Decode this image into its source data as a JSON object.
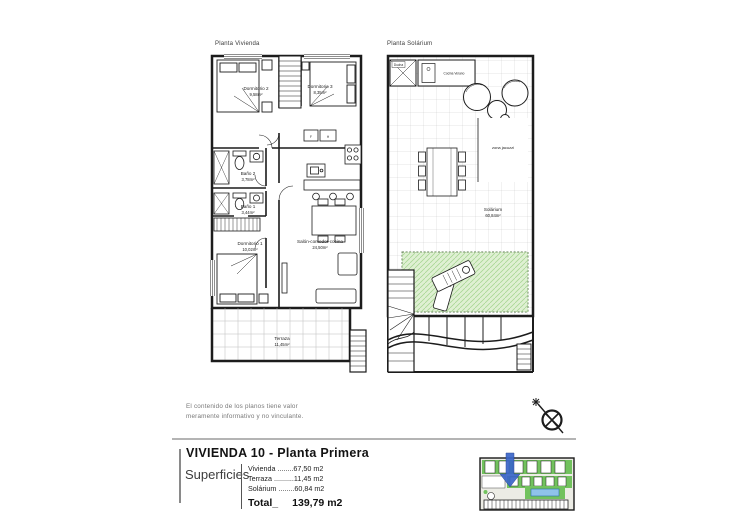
{
  "header": {
    "plan_left_title": "Planta Vivienda",
    "plan_right_title": "Planta Solárium"
  },
  "plan_left": {
    "rooms": [
      {
        "name": "Dormitorio 2",
        "area": "9,58m²"
      },
      {
        "name": "Dormitorio 3",
        "area": "8,35m²"
      },
      {
        "name": "Baño 2",
        "area": "3,78m²"
      },
      {
        "name": "Baño 1",
        "area": "3,44m²"
      },
      {
        "name": "Dormitorio 1",
        "area": "10,02m²"
      },
      {
        "name": "Salón-comedor-cocina",
        "area": "24,50m²"
      },
      {
        "name": "Terraza",
        "area": "11,45m²"
      }
    ],
    "appliances": {
      "fridge": "F",
      "oven": "H"
    }
  },
  "plan_right": {
    "labels": {
      "shower": "Ducha",
      "summer_kitchen": "Cocina Verano",
      "jacuzzi": "zona jacuzzi",
      "solarium_name": "Solárium",
      "solarium_area": "60,84m²"
    }
  },
  "disclaimer": {
    "line1": "El contenido de los planos tiene valor",
    "line2": "meramente informativo y no vinculante."
  },
  "titleblock": {
    "title": "VIVIENDA 10 - Planta Primera",
    "superficies_label": "Superficies",
    "rows": [
      {
        "text": "Vivienda ........67,50 m2"
      },
      {
        "text": "Terraza ..........11,45 m2"
      },
      {
        "text": "Solárium ........60,84 m2"
      }
    ],
    "total_label": "Total_",
    "total_value": "139,79 m2"
  },
  "colors": {
    "wall": "#1c1c1c",
    "tile_grid": "#c9c9c9",
    "green_zone": "#dff0d3",
    "green_hatch": "#a9d695",
    "site_green": "#72c25e",
    "pool_blue": "#8fc3ea",
    "arrow_blue": "#3a66c9",
    "divider_gray": "#b4b4b4"
  }
}
